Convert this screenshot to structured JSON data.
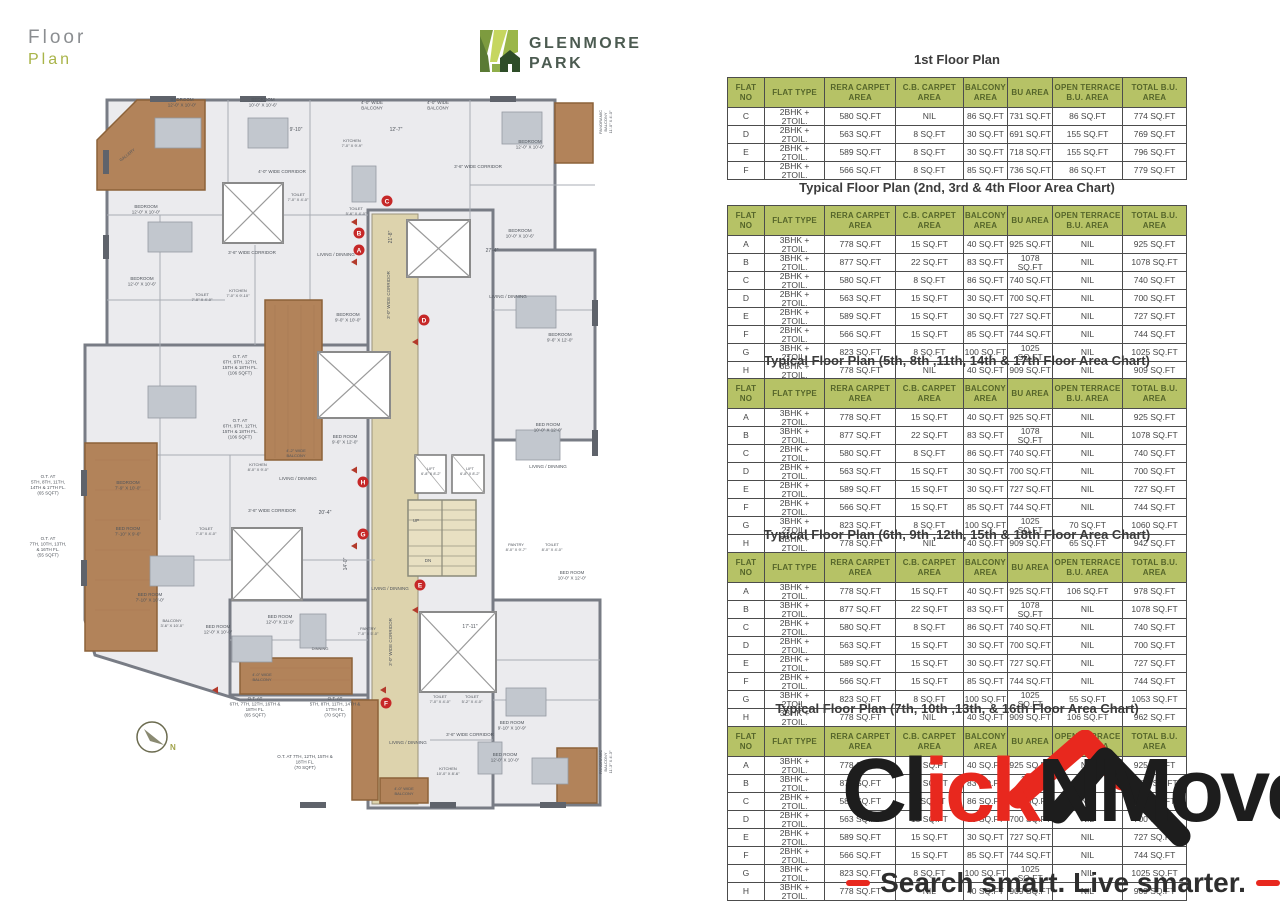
{
  "page": {
    "title_line1": "Floor",
    "title_line2": "Plan"
  },
  "brand": {
    "name_line1": "GLENMORE",
    "name_line2": "PARK"
  },
  "colors": {
    "table_header_bg": "#b6c266",
    "table_header_text": "#55652a",
    "accent_red": "#e8281e",
    "terrace_brown": "#b2835a",
    "marker_red": "#c62828"
  },
  "table_headers": [
    "FLAT NO",
    "FLAT TYPE",
    "RERA CARPET AREA",
    "C.B. CARPET AREA",
    "BALCONY AREA",
    "BU AREA",
    "OPEN TERRACE B.U. AREA",
    "TOTAL B.U. AREA"
  ],
  "floor_tables": [
    {
      "title": "1st Floor Plan",
      "top": 50,
      "rows": [
        [
          "C",
          "2BHK + 2TOIL.",
          "580 SQ.FT",
          "NIL",
          "86 SQ.FT",
          "731 SQ.FT",
          "86 SQ.FT",
          "774 SQ.FT"
        ],
        [
          "D",
          "2BHK + 2TOIL.",
          "563 SQ.FT",
          "8 SQ.FT",
          "30 SQ.FT",
          "691 SQ.FT",
          "155 SQ.FT",
          "769 SQ.FT"
        ],
        [
          "E",
          "2BHK + 2TOIL.",
          "589 SQ.FT",
          "8 SQ.FT",
          "30 SQ.FT",
          "718 SQ.FT",
          "155 SQ.FT",
          "796 SQ.FT"
        ],
        [
          "F",
          "2BHK + 2TOIL.",
          "566 SQ.FT",
          "8 SQ.FT",
          "85 SQ.FT",
          "736 SQ.FT",
          "86 SQ.FT",
          "779 SQ.FT"
        ]
      ]
    },
    {
      "title": "Typical Floor Plan (2nd, 3rd & 4th Floor Area Chart)",
      "top": 178,
      "rows": [
        [
          "A",
          "3BHK + 2TOIL.",
          "778 SQ.FT",
          "15 SQ.FT",
          "40 SQ.FT",
          "925 SQ.FT",
          "NIL",
          "925 SQ.FT"
        ],
        [
          "B",
          "3BHK + 2TOIL.",
          "877 SQ.FT",
          "22 SQ.FT",
          "83 SQ.FT",
          "1078 SQ.FT",
          "NIL",
          "1078 SQ.FT"
        ],
        [
          "C",
          "2BHK + 2TOIL.",
          "580 SQ.FT",
          "8 SQ.FT",
          "86 SQ.FT",
          "740 SQ.FT",
          "NIL",
          "740 SQ.FT"
        ],
        [
          "D",
          "2BHK + 2TOIL.",
          "563 SQ.FT",
          "15 SQ.FT",
          "30 SQ.FT",
          "700 SQ.FT",
          "NIL",
          "700 SQ.FT"
        ],
        [
          "E",
          "2BHK + 2TOIL.",
          "589 SQ.FT",
          "15 SQ.FT",
          "30 SQ.FT",
          "727 SQ.FT",
          "NIL",
          "727 SQ.FT"
        ],
        [
          "F",
          "2BHK + 2TOIL.",
          "566 SQ.FT",
          "15 SQ.FT",
          "85 SQ.FT",
          "744 SQ.FT",
          "NIL",
          "744 SQ.FT"
        ],
        [
          "G",
          "3BHK + 2TOIL.",
          "823 SQ.FT",
          "8 SQ.FT",
          "100 SQ.FT",
          "1025 SQ.FT",
          "NIL",
          "1025 SQ.FT"
        ],
        [
          "H",
          "3BHK + 2TOIL.",
          "778 SQ.FT",
          "NIL",
          "40 SQ.FT",
          "909 SQ.FT",
          "NIL",
          "909 SQ.FT"
        ]
      ]
    },
    {
      "title": "Typical Floor Plan (5th, 8th ,11th, 14th & 17th Floor Area Chart)",
      "top": 351,
      "rows": [
        [
          "A",
          "3BHK + 2TOIL.",
          "778 SQ.FT",
          "15 SQ.FT",
          "40 SQ.FT",
          "925 SQ.FT",
          "NIL",
          "925 SQ.FT"
        ],
        [
          "B",
          "3BHK + 2TOIL.",
          "877 SQ.FT",
          "22 SQ.FT",
          "83 SQ.FT",
          "1078 SQ.FT",
          "NIL",
          "1078 SQ.FT"
        ],
        [
          "C",
          "2BHK + 2TOIL.",
          "580 SQ.FT",
          "8 SQ.FT",
          "86 SQ.FT",
          "740 SQ.FT",
          "NIL",
          "740 SQ.FT"
        ],
        [
          "D",
          "2BHK + 2TOIL.",
          "563 SQ.FT",
          "15 SQ.FT",
          "30 SQ.FT",
          "700 SQ.FT",
          "NIL",
          "700 SQ.FT"
        ],
        [
          "E",
          "2BHK + 2TOIL.",
          "589 SQ.FT",
          "15 SQ.FT",
          "30 SQ.FT",
          "727 SQ.FT",
          "NIL",
          "727 SQ.FT"
        ],
        [
          "F",
          "2BHK + 2TOIL.",
          "566 SQ.FT",
          "15 SQ.FT",
          "85 SQ.FT",
          "744 SQ.FT",
          "NIL",
          "744 SQ.FT"
        ],
        [
          "G",
          "3BHK + 2TOIL.",
          "823 SQ.FT",
          "8 SQ.FT",
          "100 SQ.FT",
          "1025 SQ.FT",
          "70 SQ.FT",
          "1060 SQ.FT"
        ],
        [
          "H",
          "3BHK + 2TOIL.",
          "778 SQ.FT",
          "NIL",
          "40 SQ.FT",
          "909 SQ.FT",
          "65 SQ.FT",
          "942 SQ.FT"
        ]
      ]
    },
    {
      "title": "Typical Floor Plan (6th, 9th ,12th, 15th & 18th Floor Area Chart)",
      "top": 525,
      "rows": [
        [
          "A",
          "3BHK + 2TOIL.",
          "778 SQ.FT",
          "15 SQ.FT",
          "40 SQ.FT",
          "925 SQ.FT",
          "106 SQ.FT",
          "978 SQ.FT"
        ],
        [
          "B",
          "3BHK + 2TOIL.",
          "877 SQ.FT",
          "22 SQ.FT",
          "83 SQ.FT",
          "1078 SQ.FT",
          "NIL",
          "1078 SQ.FT"
        ],
        [
          "C",
          "2BHK + 2TOIL.",
          "580 SQ.FT",
          "8 SQ.FT",
          "86 SQ.FT",
          "740 SQ.FT",
          "NIL",
          "740 SQ.FT"
        ],
        [
          "D",
          "2BHK + 2TOIL.",
          "563 SQ.FT",
          "15 SQ.FT",
          "30 SQ.FT",
          "700 SQ.FT",
          "NIL",
          "700 SQ.FT"
        ],
        [
          "E",
          "2BHK + 2TOIL.",
          "589 SQ.FT",
          "15 SQ.FT",
          "30 SQ.FT",
          "727 SQ.FT",
          "NIL",
          "727 SQ.FT"
        ],
        [
          "F",
          "2BHK + 2TOIL.",
          "566 SQ.FT",
          "15 SQ.FT",
          "85 SQ.FT",
          "744 SQ.FT",
          "NIL",
          "744 SQ.FT"
        ],
        [
          "G",
          "3BHK + 2TOIL.",
          "823 SQ.FT",
          "8 SQ.FT",
          "100 SQ.FT",
          "1025 SQ.FT",
          "55 SQ.FT",
          "1053 SQ.FT"
        ],
        [
          "H",
          "3BHK + 2TOIL.",
          "778 SQ.FT",
          "NIL",
          "40 SQ.FT",
          "909 SQ.FT",
          "106 SQ.FT",
          "962 SQ.FT"
        ]
      ]
    },
    {
      "title": "Typical Floor Plan (7th, 10th ,13th, & 16th Floor Area Chart)",
      "top": 699,
      "rows": [
        [
          "A",
          "3BHK + 2TOIL.",
          "778 SQ.FT",
          "15 SQ.FT",
          "40 SQ.FT",
          "925 SQ.FT",
          "NIL",
          "925 SQ.FT"
        ],
        [
          "B",
          "3BHK + 2TOIL.",
          "877 SQ.FT",
          "22 SQ.FT",
          "83 SQ.FT",
          "1078 SQ.FT",
          "NIL",
          "1078 SQ.FT"
        ],
        [
          "C",
          "2BHK + 2TOIL.",
          "580 SQ.FT",
          "8 SQ.FT",
          "86 SQ.FT",
          "740 SQ.FT",
          "NIL",
          "740 SQ.FT"
        ],
        [
          "D",
          "2BHK + 2TOIL.",
          "563 SQ.FT",
          "15 SQ.FT",
          "30 SQ.FT",
          "700 SQ.FT",
          "NIL",
          "700 SQ.FT"
        ],
        [
          "E",
          "2BHK + 2TOIL.",
          "589 SQ.FT",
          "15 SQ.FT",
          "30 SQ.FT",
          "727 SQ.FT",
          "NIL",
          "727 SQ.FT"
        ],
        [
          "F",
          "2BHK + 2TOIL.",
          "566 SQ.FT",
          "15 SQ.FT",
          "85 SQ.FT",
          "744 SQ.FT",
          "NIL",
          "744 SQ.FT"
        ],
        [
          "G",
          "3BHK + 2TOIL.",
          "823 SQ.FT",
          "8 SQ.FT",
          "100 SQ.FT",
          "1025 SQ.FT",
          "NIL",
          "1025 SQ.FT"
        ],
        [
          "H",
          "3BHK + 2TOIL.",
          "778 SQ.FT",
          "NIL",
          "40 SQ.FT",
          "909 SQ.FT",
          "NIL",
          "909 SQ.FT"
        ]
      ]
    }
  ],
  "plan": {
    "compass": {
      "label": "N"
    },
    "markers": [
      {
        "t": "A",
        "x": 359,
        "y": 250
      },
      {
        "t": "B",
        "x": 359,
        "y": 233
      },
      {
        "t": "C",
        "x": 387,
        "y": 201
      },
      {
        "t": "D",
        "x": 424,
        "y": 320
      },
      {
        "t": "E",
        "x": 420,
        "y": 585
      },
      {
        "t": "F",
        "x": 386,
        "y": 703
      },
      {
        "t": "G",
        "x": 363,
        "y": 534
      },
      {
        "t": "H",
        "x": 363,
        "y": 482
      }
    ],
    "arrows": [
      {
        "x": 351,
        "y": 222
      },
      {
        "x": 351,
        "y": 262
      },
      {
        "x": 351,
        "y": 470
      },
      {
        "x": 351,
        "y": 546
      },
      {
        "x": 412,
        "y": 342
      },
      {
        "x": 412,
        "y": 610
      },
      {
        "x": 380,
        "y": 690
      },
      {
        "x": 212,
        "y": 690
      }
    ],
    "labels": [
      {
        "t": "BEDROOM\n12'-0\" X 10'-0\"",
        "x": 182,
        "y": 101
      },
      {
        "t": "BEDROOM\n10'-0\" X 10'-6\"",
        "x": 263,
        "y": 101
      },
      {
        "t": "4'-0\" WIDE\nBALCONY",
        "x": 372,
        "y": 104
      },
      {
        "t": "4'-0\" WIDE\nBALCONY",
        "x": 438,
        "y": 104
      },
      {
        "t": "BEDROOM\n12'-0\" X 10'-0\"",
        "x": 530,
        "y": 143
      },
      {
        "t": "KITCHEN\n7'-0\" X 9'-9\"",
        "x": 352,
        "y": 142,
        "s": 4
      },
      {
        "t": "GALLERY",
        "x": 128,
        "y": 156,
        "s": 4,
        "r": -38
      },
      {
        "t": "9'-10\"",
        "x": 296,
        "y": 131,
        "s": 5
      },
      {
        "t": "12'-7\"",
        "x": 396,
        "y": 131,
        "s": 5
      },
      {
        "t": "BEDROOM\n12'-0\" X 10'-0\"",
        "x": 146,
        "y": 208
      },
      {
        "t": "4'-0\" WIDE CORRIDOR",
        "x": 282,
        "y": 173,
        "s": 4.5
      },
      {
        "t": "3'-6\" WIDE CORRIDOR",
        "x": 478,
        "y": 168,
        "s": 4.5
      },
      {
        "t": "TOILET\n7'-0\" X 4'-0\"",
        "x": 298,
        "y": 196,
        "s": 4
      },
      {
        "t": "TOILET\n5'-6\" X 4'-0\"",
        "x": 356,
        "y": 210,
        "s": 4
      },
      {
        "t": "LIVING / DINNING",
        "x": 336,
        "y": 256,
        "s": 4.5
      },
      {
        "t": "BEDROOM\n10'-0\" X 10'-6\"",
        "x": 520,
        "y": 232
      },
      {
        "t": "21'-8\"",
        "x": 392,
        "y": 237,
        "s": 5,
        "r": -90
      },
      {
        "t": "BEDROOM\n12'-0\" X 10'-6\"",
        "x": 142,
        "y": 280
      },
      {
        "t": "TOILET\n7'-0\" X 4'-0\"",
        "x": 202,
        "y": 296,
        "s": 4
      },
      {
        "t": "KITCHEN\n7'-0\" X 9'-10\"",
        "x": 238,
        "y": 292,
        "s": 4
      },
      {
        "t": "3'-6\" WIDE CORRIDOR",
        "x": 252,
        "y": 254,
        "s": 4.5
      },
      {
        "t": "LIVING / DINNING",
        "x": 508,
        "y": 298,
        "s": 4.5
      },
      {
        "t": "27'-4\"",
        "x": 492,
        "y": 252,
        "s": 5
      },
      {
        "t": "BEDROOM\n9'-6\" X 12'-0\"",
        "x": 560,
        "y": 336
      },
      {
        "t": "BEDROOM\n9'-0\" X 10'-0\"",
        "x": 348,
        "y": 316
      },
      {
        "t": "3'-0\" WIDE CORRIDOR",
        "x": 390,
        "y": 295,
        "s": 4.5,
        "r": -90
      },
      {
        "t": "BED ROOM\n9'-6\" X 12'-0\"",
        "x": 345,
        "y": 438
      },
      {
        "t": "BED ROOM\n10'-0\" X 12'-0\"",
        "x": 548,
        "y": 426
      },
      {
        "t": "4'-2\" WIDE\nBALCONY",
        "x": 296,
        "y": 452,
        "s": 4
      },
      {
        "t": "BEDROOM\n7'-9\" X 10'-0\"",
        "x": 128,
        "y": 484
      },
      {
        "t": "BED ROOM\n7'-10\" X 9'-6\"",
        "x": 128,
        "y": 530
      },
      {
        "t": "TOILET\n7'-0\" X 4'-0\"",
        "x": 206,
        "y": 530,
        "s": 4
      },
      {
        "t": "KITCHEN\n8'-0\" X 9'-0\"",
        "x": 258,
        "y": 466,
        "s": 4
      },
      {
        "t": "LIVING / DINNING",
        "x": 298,
        "y": 480,
        "s": 4.5
      },
      {
        "t": "LIVING / DINNING",
        "x": 548,
        "y": 468,
        "s": 4.5
      },
      {
        "t": "3'-6\" WIDE CORRIDOR",
        "x": 272,
        "y": 512,
        "s": 4.5
      },
      {
        "t": "20'-4\"",
        "x": 325,
        "y": 514,
        "s": 5
      },
      {
        "t": "LIFT\n6'-8\" X 8'-2\"",
        "x": 431,
        "y": 470,
        "s": 3.8
      },
      {
        "t": "LIFT\n6'-8\" X 8'-2\"",
        "x": 470,
        "y": 470,
        "s": 3.8
      },
      {
        "t": "UP",
        "x": 416,
        "y": 522,
        "s": 4.5
      },
      {
        "t": "DN",
        "x": 428,
        "y": 562,
        "s": 4.5
      },
      {
        "t": "PANTRY\n8'-0\" X 9'-7\"",
        "x": 516,
        "y": 546,
        "s": 4
      },
      {
        "t": "TOILET\n8'-0\" X 4'-0\"",
        "x": 552,
        "y": 546,
        "s": 4
      },
      {
        "t": "BED ROOM\n10'-0\" X 12'-0\"",
        "x": 572,
        "y": 574
      },
      {
        "t": "LIVING / DINNING",
        "x": 390,
        "y": 590,
        "s": 4.5
      },
      {
        "t": "14'-0\"",
        "x": 347,
        "y": 564,
        "s": 5,
        "r": -90
      },
      {
        "t": "3'-0\" WIDE CORRIDOR",
        "x": 392,
        "y": 642,
        "s": 4.5,
        "r": -90
      },
      {
        "t": "17'-11\"",
        "x": 470,
        "y": 628,
        "s": 5
      },
      {
        "t": "BED ROOM\n7'-10\" X 10'-0\"",
        "x": 150,
        "y": 596
      },
      {
        "t": "BALCONY\n3'-6\" X 10'-0\"",
        "x": 172,
        "y": 622,
        "s": 4
      },
      {
        "t": "BED ROOM\n12'-0\" X 10'-0\"",
        "x": 218,
        "y": 628
      },
      {
        "t": "BED ROOM\n12'-0\" X 11'-0\"",
        "x": 280,
        "y": 618
      },
      {
        "t": "DINNING",
        "x": 320,
        "y": 650,
        "s": 4
      },
      {
        "t": "PANTRY\n7'-0\" X 5'-0\"",
        "x": 368,
        "y": 630,
        "s": 4
      },
      {
        "t": "4'-0\" WIDE\nBALCONY",
        "x": 262,
        "y": 676,
        "s": 4
      },
      {
        "t": "TOILET\n7'-0\" X 4'-0\"",
        "x": 440,
        "y": 698,
        "s": 4
      },
      {
        "t": "TOILET\n5'-2\" X 4'-0\"",
        "x": 472,
        "y": 698,
        "s": 4
      },
      {
        "t": "BED ROOM\n9'-10\" X 10'-9\"",
        "x": 512,
        "y": 724
      },
      {
        "t": "BED ROOM\n12'-0\" X 10'-0\"",
        "x": 505,
        "y": 756
      },
      {
        "t": "LIVING / DINNING",
        "x": 408,
        "y": 744,
        "s": 4.5
      },
      {
        "t": "KITCHEN\n10'-0\" X 8'-6\"",
        "x": 448,
        "y": 770,
        "s": 4
      },
      {
        "t": "3'-6\" WIDE CORRIDOR",
        "x": 470,
        "y": 736,
        "s": 4.5
      },
      {
        "t": "4'-0\" WIDE\nBALCONY",
        "x": 404,
        "y": 790,
        "s": 4
      },
      {
        "t": "PANORAMIC\nBALCONY\n11'-0\" X 4'-0\"",
        "x": 602,
        "y": 122,
        "s": 4,
        "r": -90
      },
      {
        "t": "PANORAMIC\nBALCONY\n11'-3\" X 4'-3\"",
        "x": 602,
        "y": 762,
        "s": 4,
        "r": -90
      },
      {
        "t": "O.T. AT\n5TH, 8TH, 11TH,\n14TH & 17TH FL.\n(65 SQFT)",
        "x": 48,
        "y": 478,
        "s": 4.5
      },
      {
        "t": "O.T. AT\n7TH, 10TH, 13TH,\n& 16TH FL.\n(55 SQFT)",
        "x": 48,
        "y": 540,
        "s": 4.5
      },
      {
        "t": "O.T. AT\n6TH, 9TH, 12TH,\n15TH & 18TH FL.\n(106 SQFT)",
        "x": 240,
        "y": 358,
        "s": 4.5
      },
      {
        "t": "O.T. AT\n6TH, 9TH, 12TH,\n15TH & 18TH FL.\n(106 SQFT)",
        "x": 240,
        "y": 422,
        "s": 4.5
      },
      {
        "t": "O.T. AT\n6TH, 7TH, 12TH, 16TH &\n18TH FL.\n(65 SQFT)",
        "x": 255,
        "y": 700,
        "s": 4.5
      },
      {
        "t": "O.T. AT\n5TH, 8TH, 11TH, 14TH &\n17TH FL.\n(70 SQFT)",
        "x": 335,
        "y": 700,
        "s": 4.5
      },
      {
        "t": "O.T. AT 7TH, 12TH, 15TH &\n18TH FL.\n(70 SQFT)",
        "x": 305,
        "y": 758,
        "s": 4.5
      }
    ]
  },
  "watermark": {
    "text_black_1": "Cl",
    "text_red": "ick",
    "text_black_2": "NMove",
    "tagline": "Search smart. Live smarter."
  }
}
